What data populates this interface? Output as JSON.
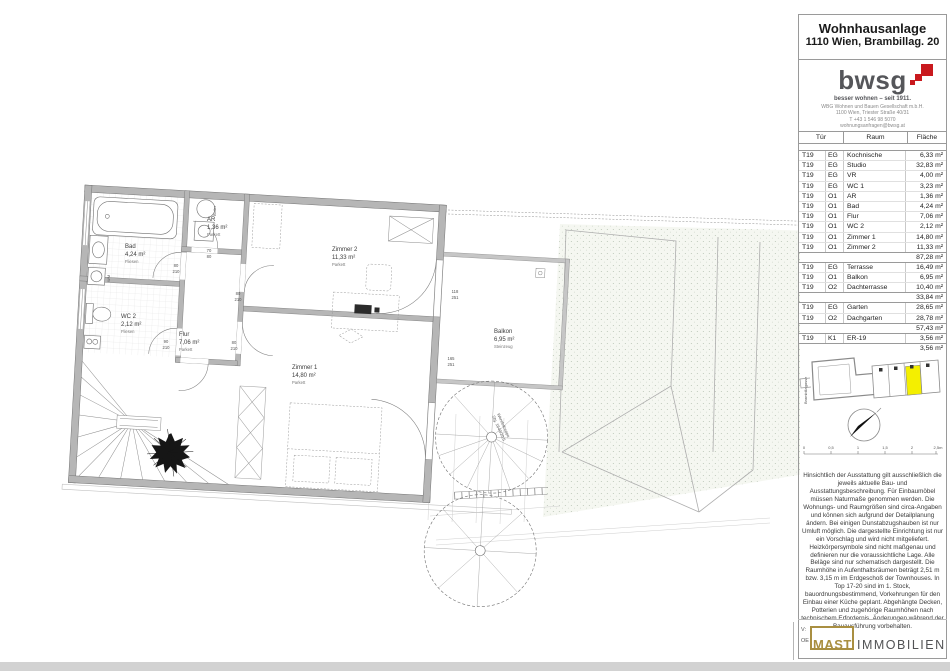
{
  "header": {
    "title": "Wohnhausanlage",
    "subtitle": "1110 Wien, Brambillag. 20"
  },
  "brand": {
    "logo": "bwsg",
    "tagline": "besser wohnen – seit 1911.",
    "line1": "WBG Wohnen und Bauen Gesellschaft m.b.H.",
    "line2": "1100 Wien, Triester Straße 40/31",
    "line3": "T +43 1 546 98 5070",
    "line4": "wohnungsanfragen@bwsg.at"
  },
  "table": {
    "headers": [
      "Tür",
      "Raum",
      "Fläche"
    ],
    "groups": [
      {
        "rows": [
          [
            "T19",
            "EG",
            "Kochnische",
            "6,33 m²"
          ],
          [
            "T19",
            "EG",
            "Studio",
            "32,83 m²"
          ],
          [
            "T19",
            "EG",
            "VR",
            "4,00 m²"
          ],
          [
            "T19",
            "EG",
            "WC 1",
            "3,23 m²"
          ],
          [
            "T19",
            "O1",
            "AR",
            "1,36 m²"
          ],
          [
            "T19",
            "O1",
            "Bad",
            "4,24 m²"
          ],
          [
            "T19",
            "O1",
            "Flur",
            "7,06 m²"
          ],
          [
            "T19",
            "O1",
            "WC 2",
            "2,12 m²"
          ],
          [
            "T19",
            "O1",
            "Zimmer 1",
            "14,80 m²"
          ],
          [
            "T19",
            "O1",
            "Zimmer 2",
            "11,33 m²"
          ]
        ],
        "total": "87,28 m²"
      },
      {
        "rows": [
          [
            "T19",
            "EG",
            "Terrasse",
            "16,49 m²"
          ],
          [
            "T19",
            "O1",
            "Balkon",
            "6,95 m²"
          ],
          [
            "T19",
            "O2",
            "Dachterrasse",
            "10,40 m²"
          ]
        ],
        "total": "33,84 m²"
      },
      {
        "rows": [
          [
            "T19",
            "EG",
            "Garten",
            "28,65 m²"
          ],
          [
            "T19",
            "O2",
            "Dachgarten",
            "28,78 m²"
          ]
        ],
        "total": "57,43 m²"
      },
      {
        "rows": [
          [
            "T19",
            "K1",
            "ER-19",
            "3,56 m²"
          ]
        ],
        "total": "3,56 m²"
      }
    ]
  },
  "keyplan": {
    "street": "Brambillagasse",
    "scale": [
      "0",
      "0,5",
      "1",
      "1,5",
      "2",
      "2,5m"
    ]
  },
  "disclaimer": "Hinsichtlich der Ausstattung gilt ausschließlich die jeweils aktuelle Bau- und Ausstattungsbeschreibung. Für Einbaumöbel müssen Naturmaße genommen werden. Die Wohnungs- und Raumgrößen sind circa-Angaben und können sich aufgrund der Detailplanung ändern. Bei einigen Dunstabzugshauben ist nur Umluft möglich. Die dargestellte Einrichtung ist nur ein Vorschlag und wird nicht mitgeliefert. Heizkörpersymbole sind nicht maßgenau und definieren nur die voraussichtliche Lage. Alle Beläge sind nur schematisch dargestellt. Die Raumhöhe in Aufenthaltsräumen beträgt 2,51 m bzw. 3,15 m im Erdgeschoß der Townhouses. In Top 17-20 sind im 1. Stock, bauordnungsbestimmend, Vorkehrungen für den Einbau einer Küche geplant. Abgehängte Decken, Potterien und zugehörige Raumhöhen nach technischem Erfordernis. Änderungen während der Bauausführung vorbehalten.",
  "footer": {
    "v": "V:",
    "oe": "OE",
    "mast": "MAST",
    "immobilien": "IMMOBILIEN"
  },
  "plan": {
    "rooms": [
      {
        "name": "Bad",
        "area": "4,24 m²",
        "material": "Fliesen"
      },
      {
        "name": "WC 2",
        "area": "2,12 m²",
        "material": "Fliesen"
      },
      {
        "name": "Flur",
        "area": "7,06 m²",
        "material": "Parkett"
      },
      {
        "name": "AR",
        "area": "1,36 m²",
        "material": "Parkett"
      },
      {
        "name": "Zimmer 2",
        "area": "11,33 m²",
        "material": "Parkett"
      },
      {
        "name": "Zimmer 1",
        "area": "14,80 m²",
        "material": "Parkett"
      },
      {
        "name": "Balkon",
        "area": "6,95 m²",
        "material": "Steinzeug"
      }
    ],
    "dims": [
      {
        "a": "80",
        "b": "210"
      },
      {
        "a": "80",
        "b": "210"
      },
      {
        "a": "80",
        "b": "210"
      },
      {
        "a": "90",
        "b": "210"
      },
      {
        "a": "118",
        "b": "251"
      },
      {
        "a": "165",
        "b": "251"
      },
      {
        "a": "70",
        "b": "80"
      }
    ],
    "boiler": "Boiler",
    "wm": "WM",
    "stair_note_1": "Wendeltreppe",
    "stair_note_2": "Stg. 1640/20,5"
  }
}
